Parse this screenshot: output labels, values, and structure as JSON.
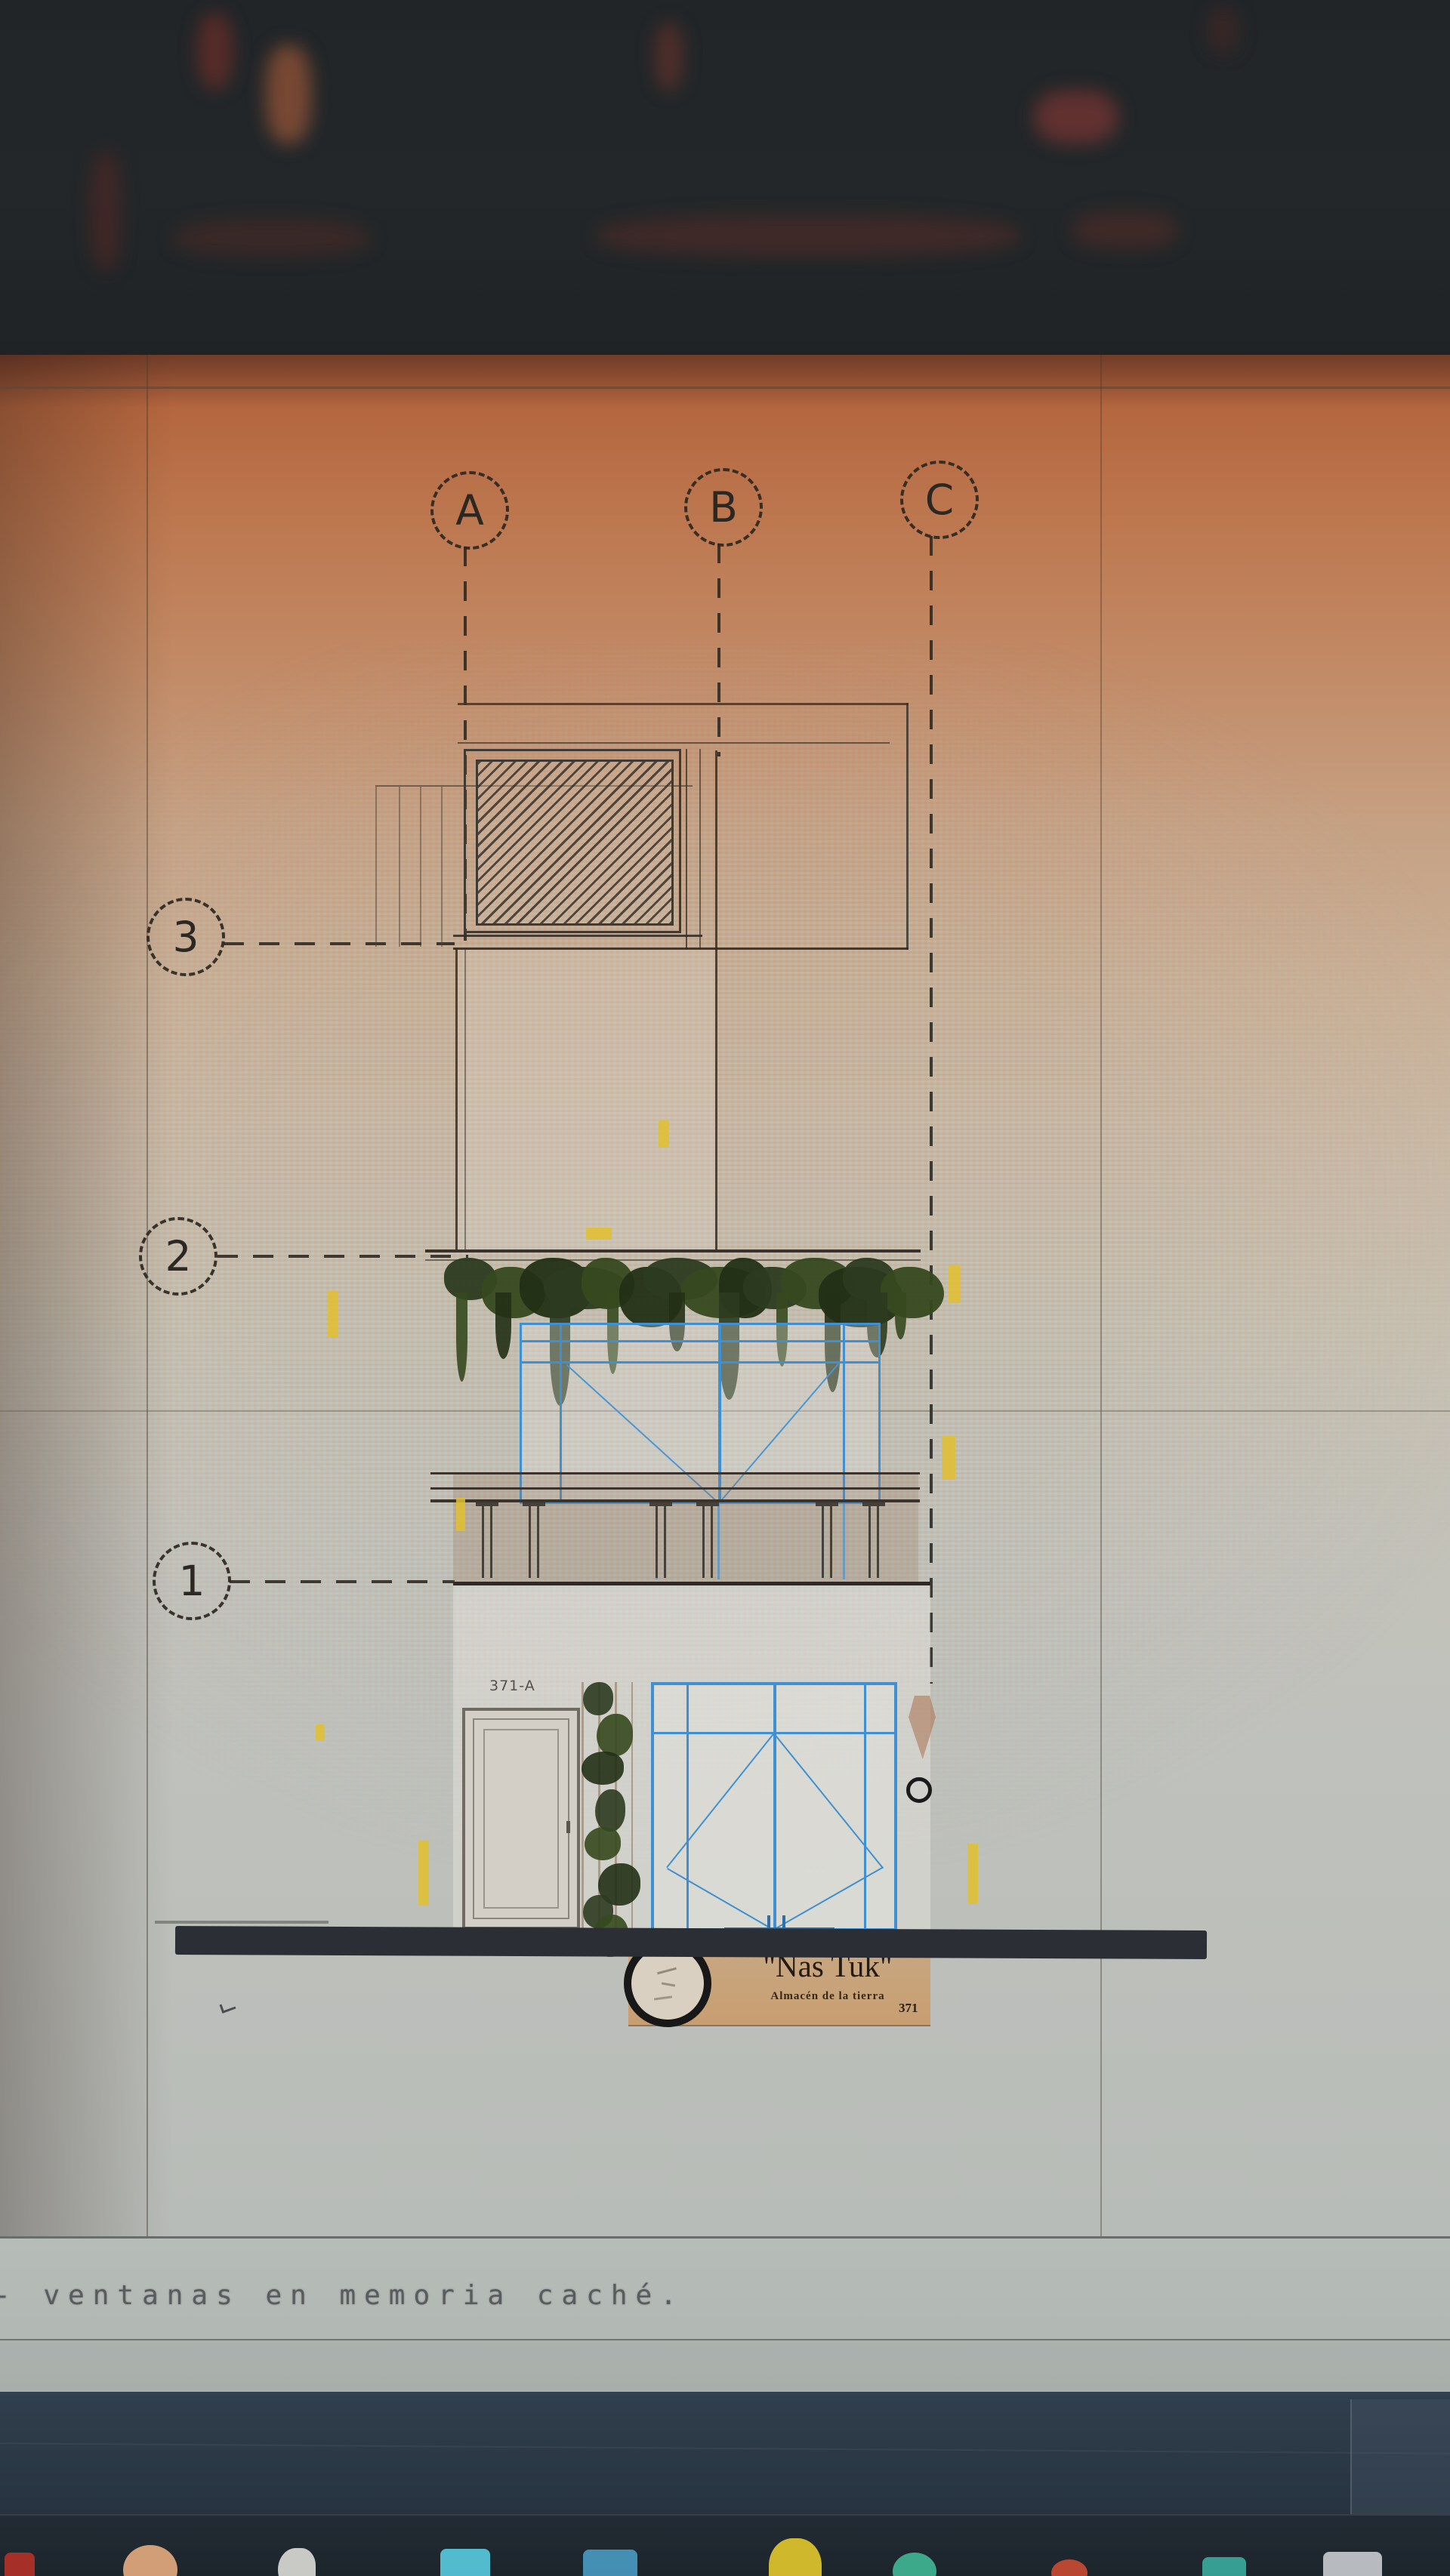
{
  "drawing": {
    "column_axes": [
      "A",
      "B",
      "C"
    ],
    "level_axes": [
      "3",
      "2",
      "1"
    ],
    "title": "FACHADA PRINCIPAL",
    "sign": {
      "display_name": "\"Nas Tuk\"",
      "subtitle": "Almacén de la tierra",
      "street_number": "371",
      "left_unit_label": "371-A"
    }
  },
  "command_line": {
    "prefix": "-",
    "message": "ventanas en memoria caché."
  },
  "taskbar": {
    "icons": [
      {
        "name": "app-icon-red-square",
        "color": "#b23028",
        "shape": "square"
      },
      {
        "name": "app-icon-peach-circle",
        "color": "#e2a87e",
        "shape": "circle"
      },
      {
        "name": "app-icon-white-blob",
        "color": "#d8d8d2",
        "shape": "blob"
      },
      {
        "name": "app-icon-cyan-square",
        "color": "#57c8dc",
        "shape": "square"
      },
      {
        "name": "app-icon-blue-square",
        "color": "#4898c0",
        "shape": "square"
      },
      {
        "name": "app-icon-yellow-round",
        "color": "#e0c42e",
        "shape": "round"
      },
      {
        "name": "app-icon-teal-circle",
        "color": "#40b494",
        "shape": "circle"
      },
      {
        "name": "app-icon-redorange-circle",
        "color": "#c84a32",
        "shape": "circle"
      },
      {
        "name": "app-icon-green-square",
        "color": "#38a89c",
        "shape": "square"
      },
      {
        "name": "app-icon-gray-square",
        "color": "#c4c8cc",
        "shape": "square"
      }
    ]
  },
  "colors": {
    "glass_frame_blue": "#3f8fd2",
    "sign_band_tan": "#c4a27e",
    "dimension_yellow": "#e2bf2e",
    "foliage_green": "#32431f",
    "ground_bar_dark": "#2b2e35",
    "sheet_salmon_top": "#b5673f",
    "sheet_gray_bottom": "#b7bbb7"
  }
}
